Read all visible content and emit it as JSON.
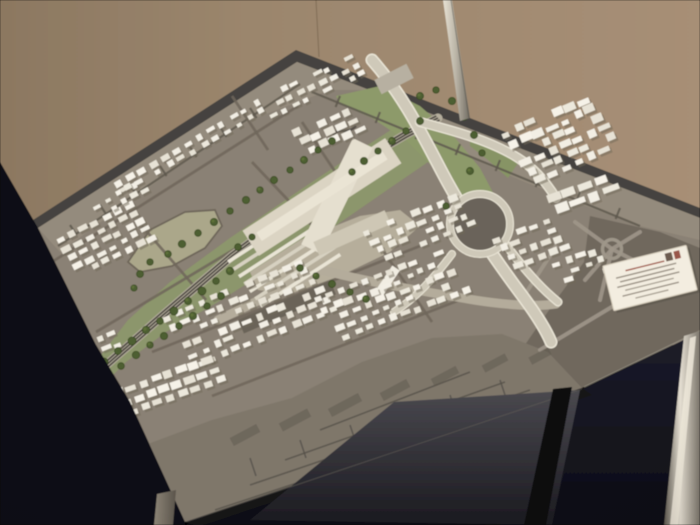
{
  "scene": {
    "description": "Photograph of an architectural scale model of a city district with a central railway station, motorway interchange, green rail corridor and dense white building blocks, displayed on a glass table in front of a beige exhibition wall",
    "card_note": "small white information card on model, text illegible"
  },
  "palette": {
    "wall_left": "#8c7861",
    "wall_mid": "#9b866d",
    "wall_right": "#a78f76",
    "board_base": "#8a8174",
    "rim": "#454340",
    "far_band": "#948b7d",
    "band_street": "#5e584e",
    "right_block": "#6f685d",
    "right_street": "#9e9689",
    "near_flat": "#7f776b",
    "near_line": "#555048",
    "green": "#8c966c",
    "green2": "#8d9a6a",
    "green3": "#879465",
    "field": "#aba78a",
    "plaza": "#b6ae9b",
    "street_dark": "#6e665a",
    "rail_bed": "#b5ae9d",
    "rail": "#4e4943",
    "hw_casing": "#ebe6d7",
    "hw_core": "#cfc9b9",
    "hw_shadow": "#5a544b",
    "forecourt": "#b4ac9b",
    "loop_inner": "#6a645a",
    "bldg_shadow": "#6f6858",
    "slab_dark": "#6b6459",
    "slab_gray": "#b7b0a1",
    "station_a": "#dbd4c3",
    "station_b": "#e5dfcf",
    "station_c": "#eae4d4",
    "station_d": "#cec7b5",
    "tree": "#4d5e32",
    "tree_dark": "#38491f",
    "navy": "#0e0e15",
    "navy2": "#1c1c2a",
    "glass_hi": "#4a494f",
    "glass_lo": "#1b1a20",
    "card_face": "#f3ede0",
    "card_edge": "#d5ccba",
    "card_text": "#9a9184",
    "card_red": "#a05848"
  },
  "model": {
    "whites": [
      "#f2eee4",
      "#ece8dc",
      "#e7e2d5",
      "#f6f2e8"
    ],
    "base_polys": [
      {
        "name": "board-rim",
        "points": "30,222 296,50 700,208 700,218 297,62 38,228",
        "fill": "#454340"
      },
      {
        "name": "board-surface",
        "points": "38,228 297,62 700,218 700,332 582,388 185,522 130,402 96,345",
        "fill": "#8a8174"
      },
      {
        "name": "flat-band-far",
        "points": "38,228 297,62 700,218 700,240 640,226 580,204 520,180 460,153 430,140 396,112 372,90 330,90 250,120 190,158 120,208 60,252",
        "fill": "#948b7d"
      },
      {
        "name": "flat-area-right",
        "points": "590,216 660,232 700,248 700,330 582,388 520,352 556,300 584,262",
        "fill": "#6f685d"
      },
      {
        "name": "flat-strip-near",
        "points": "132,450 212,420 292,398 362,362 432,338 502,334 548,352 582,388 185,522 148,498",
        "fill": "#7f776b"
      },
      {
        "name": "green-corridor",
        "points": "88,372 128,320 170,282 230,238 300,190 360,150 400,124 436,122 448,134 428,162 390,188 338,224 278,264 218,302 166,332 126,362 104,384",
        "fill": "#8c966c"
      },
      {
        "name": "green-interchange",
        "points": "336,96 380,86 420,106 452,134 480,168 498,202 502,236 470,210 440,174 408,142 372,118 340,104",
        "fill": "#8d9a6a"
      },
      {
        "name": "green-wedge",
        "points": "470,132 500,144 520,160 508,178 488,160 470,146",
        "fill": "#879465"
      },
      {
        "name": "open-field",
        "points": "128,262 150,230 185,212 215,210 222,226 205,248 172,266 140,272",
        "fill": "#aba78a",
        "stroke": "#6e665a",
        "sw": 1.8
      },
      {
        "name": "station-plaza",
        "points": "250,272 300,240 360,216 400,210 420,226 390,252 340,276 290,294 258,290",
        "fill": "#b6ae9b"
      }
    ],
    "band_streets": [
      "M58,246 L300,84",
      "M312,92 L640,226",
      "M70,225 l6.6,10",
      "M100,205 l6.6,10",
      "M130,185 l6.6,10",
      "M160,166 l6.6,10",
      "M190,147 l6.6,10",
      "M220,127 l6.6,10",
      "M250,108 l6.6,10",
      "M340,96 l-4.4,11",
      "M380,112 l-4.4,11",
      "M420,128 l-4.4,11",
      "M460,144 l-4.4,11",
      "M500,160 l-4.4,11",
      "M540,176 l-4.4,11",
      "M580,192 l-4.4,11",
      "M620,208 l-4.4,11"
    ],
    "right_streets": [
      "M612,249 L575,222",
      "M612,249 L585,280",
      "M612,249 L640,232",
      "M612,249 L652,270",
      "M612,249 L600,300",
      "M540,350 L665,275",
      "M560,240 L524,296"
    ],
    "roundabout": {
      "cx": 612,
      "cy": 249,
      "r": 9.5
    },
    "near_lines": [
      "M555,398 L215,510",
      "M530,390 L250,485",
      "M505,382 L285,460",
      "M470,372 L320,430",
      "M300,440 l6,18",
      "M350,425 l6,18",
      "M400,410 l6,18",
      "M450,395 l6,18",
      "M250,458 l6,18",
      "M500,380 l6,18"
    ],
    "streaks": [
      [
        245,
        435,
        9,
        30,
        62
      ],
      [
        295,
        420,
        9,
        32,
        62
      ],
      [
        345,
        405,
        9,
        34,
        62
      ],
      [
        395,
        390,
        9,
        30,
        62
      ],
      [
        445,
        376,
        8,
        28,
        62
      ],
      [
        495,
        363,
        8,
        26,
        62
      ],
      [
        540,
        356,
        8,
        22,
        62
      ]
    ],
    "dark_streets": [
      "M52,262 L298,106",
      "M96,332 L340,186",
      "M152,352 L420,246",
      "M212,396 L470,296",
      "M142,226 L206,300",
      "M252,162 L322,236",
      "M302,122 L342,182",
      "M384,252 L432,322",
      "M232,96 L268,150"
    ],
    "river_squiggle": "M333,135 C340,126 346,136 356,126",
    "railway": {
      "path": [
        [
          96,
          374
        ],
        [
          162,
          316
        ],
        [
          232,
          256
        ],
        [
          300,
          206
        ],
        [
          368,
          157
        ],
        [
          405,
          135
        ],
        [
          438,
          118
        ]
      ],
      "bed_w": 9,
      "rail_w": 1.7,
      "off_x": 1.7,
      "off_y": 2.0
    },
    "forecourt_d": "M218,320 C262,300 292,282 322,270 C368,282 426,292 474,300 C506,305 534,307 556,304",
    "highway": {
      "main": "M372,60 C402,94 420,130 442,172 C464,214 494,258 524,298 C538,317 546,330 551,342",
      "ramp1": "M420,122 C450,130 490,140 518,158 C534,168 546,182 556,198",
      "connector": "M504,242 C520,264 538,286 558,302",
      "ramp_sw": "M452,254 C434,278 416,298 394,312",
      "loop": {
        "cx": 480,
        "cy": 224,
        "r_inner": 27,
        "r_ring": 30
      }
    },
    "station_bands": [
      [
        322,
        197,
        170,
        30,
        -33,
        "#dbd4c3"
      ],
      [
        337,
        196,
        118,
        22,
        -64,
        "#e5dfcf"
      ],
      [
        322,
        196,
        150,
        10,
        -33,
        "#eae4d4"
      ],
      [
        352,
        233,
        78,
        15,
        -24,
        "#cec7b5"
      ]
    ],
    "platforms": {
      "x": 268,
      "y": 236,
      "n": 7,
      "dx": 5.4,
      "dy": 7.4,
      "len": 95,
      "wid": 3.6,
      "a": -33
    },
    "special_buildings": [
      [
        394,
        79,
        36,
        16,
        -27,
        "#b7b0a1"
      ],
      [
        386,
        283,
        36,
        9,
        -56,
        "#f1ede2"
      ],
      [
        287,
        307,
        100,
        15,
        -23,
        "#6b6459"
      ]
    ],
    "clusters": [
      [
        118,
        183,
        13,
        2,
        11.5,
        -6.6,
        6,
        8,
        7,
        5,
        -30
      ],
      [
        262,
        100,
        9,
        3,
        11,
        -5.2,
        6,
        8,
        7.5,
        5,
        -27
      ],
      [
        298,
        132,
        5,
        3,
        12,
        -5,
        6.5,
        8.5,
        9,
        6,
        -25
      ],
      [
        505,
        134,
        7,
        6,
        13,
        -5.5,
        7,
        9,
        10,
        6.5,
        -23
      ],
      [
        553,
        198,
        4,
        2,
        16,
        -6,
        9,
        10,
        14,
        8,
        -20
      ],
      [
        368,
        232,
        8,
        4,
        12,
        -4.8,
        6.5,
        8.8,
        8,
        5.5,
        -22
      ],
      [
        498,
        240,
        5,
        4,
        12,
        -4.5,
        6.5,
        8.5,
        9,
        6,
        -20
      ],
      [
        556,
        264,
        4,
        3,
        12.5,
        -4,
        7,
        8.5,
        8.5,
        5.5,
        -17
      ],
      [
        60,
        240,
        7,
        5,
        11.5,
        -5.8,
        5.8,
        8.2,
        8,
        5.2,
        -27
      ],
      [
        96,
        206,
        5,
        2,
        11,
        -6,
        6,
        8,
        7,
        4.6,
        -28
      ],
      [
        166,
        318,
        12,
        6,
        12,
        -5,
        6.8,
        9.2,
        8,
        5.6,
        -22
      ],
      [
        318,
        300,
        11,
        5,
        12,
        -4.6,
        7,
        9,
        8,
        5.5,
        -21
      ],
      [
        118,
        392,
        8,
        3,
        12.5,
        -4.6,
        7.5,
        9.8,
        9,
        6,
        -19
      ],
      [
        76,
        350,
        4,
        2,
        12,
        -5,
        7,
        9,
        8,
        5,
        -22
      ]
    ],
    "trees": [
      [
        104,
        362,
        4
      ],
      [
        118,
        351,
        3.5
      ],
      [
        132,
        341,
        4
      ],
      [
        146,
        330,
        3.8
      ],
      [
        160,
        321,
        3.4
      ],
      [
        174,
        311,
        4
      ],
      [
        188,
        301,
        3.6
      ],
      [
        202,
        291,
        4
      ],
      [
        216,
        281,
        3.4
      ],
      [
        230,
        271,
        3.8
      ],
      [
        121,
        366,
        3.4
      ],
      [
        136,
        355,
        3.8
      ],
      [
        150,
        345,
        3.3
      ],
      [
        164,
        336,
        3.7
      ],
      [
        179,
        326,
        3.4
      ],
      [
        193,
        316,
        3.8
      ],
      [
        207,
        306,
        3.3
      ],
      [
        221,
        296,
        3.6
      ],
      [
        168,
        254,
        3.4
      ],
      [
        182,
        244,
        3.8
      ],
      [
        198,
        233,
        3.4
      ],
      [
        214,
        222,
        3.7
      ],
      [
        230,
        211,
        3.3
      ],
      [
        246,
        200,
        3.7
      ],
      [
        260,
        190,
        3.3
      ],
      [
        274,
        180,
        3.6
      ],
      [
        290,
        170,
        3.2
      ],
      [
        304,
        160,
        3.6
      ],
      [
        318,
        150,
        3.2
      ],
      [
        332,
        141,
        3.5
      ],
      [
        352,
        172,
        3.4
      ],
      [
        364,
        161,
        3.7
      ],
      [
        378,
        151,
        3.3
      ],
      [
        392,
        141,
        3.6
      ],
      [
        406,
        131,
        3.3
      ],
      [
        420,
        121,
        3.6
      ],
      [
        420,
        96,
        3.6
      ],
      [
        436,
        90,
        3.3
      ],
      [
        452,
        101,
        3.7
      ],
      [
        464,
        117,
        3.3
      ],
      [
        474,
        135,
        3.6
      ],
      [
        482,
        153,
        3.3
      ],
      [
        470,
        171,
        3.6
      ],
      [
        446,
        206,
        3.3
      ],
      [
        300,
        268,
        3.5
      ],
      [
        316,
        276,
        3.3
      ],
      [
        332,
        284,
        3.6
      ],
      [
        350,
        292,
        3.3
      ],
      [
        366,
        299,
        3.5
      ],
      [
        150,
        262,
        3.3
      ],
      [
        140,
        274,
        3.5
      ],
      [
        134,
        288,
        3.2
      ],
      [
        238,
        247,
        3.4
      ],
      [
        252,
        237,
        3.2
      ]
    ],
    "card": {
      "cx": 650,
      "cy": 278,
      "w": 86,
      "h": 46,
      "angle": -14,
      "lines": [
        [
          -13,
          40,
          "#a05848"
        ],
        [
          -8,
          62,
          "#9a9184"
        ],
        [
          -3.4,
          56,
          "#9a9184"
        ],
        [
          1.2,
          64,
          "#9a9184"
        ],
        [
          6,
          50,
          "#a8a093"
        ],
        [
          11,
          58,
          "#9a9184"
        ],
        [
          16,
          34,
          "#a8a093"
        ]
      ]
    },
    "foreground": {
      "navy_left": "0,162 38,228 96,345 130,402 185,522 185,525 0,525",
      "navy_bottom": "580,390 700,332 700,525 185,525",
      "edge_band": "582,388 592,395 198,527 185,522",
      "glass": "394,402 580,390 552,525 250,520",
      "leg_silver": "684,336 700,331 700,525 664,525",
      "leg_silver_core": "690,338 696,336 678,525 670,525",
      "leg_dark": "553,389 572,387 546,525 524,525",
      "leg_gray": "157,494 176,490 173,525 154,525",
      "pole": "443,0 452,0 470,118 460,121"
    }
  }
}
